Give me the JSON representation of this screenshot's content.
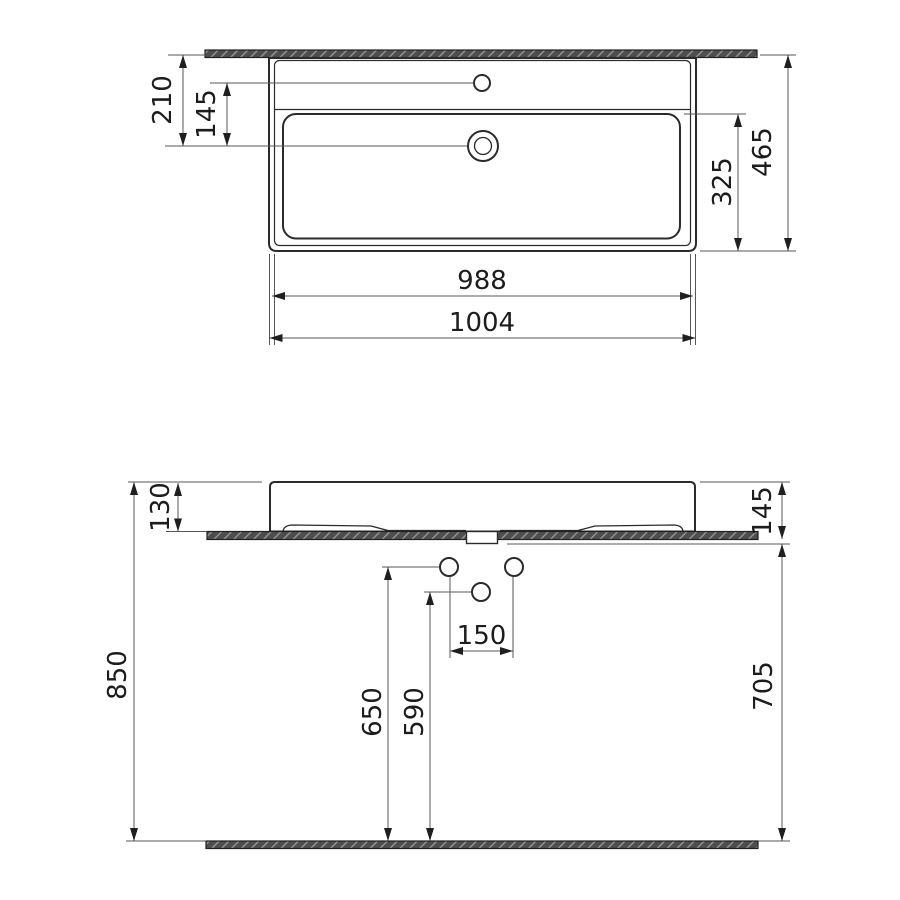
{
  "title": "Wall-hung washbasin dimensional drawing",
  "units": "mm",
  "colors": {
    "background": "#ffffff",
    "outline": "#2b2b2b",
    "dimension_lines": "#575757",
    "text": "#1c1c1c",
    "section_fill": "#4e4e4e",
    "section_hatch": "#9a9a9a"
  },
  "views": {
    "top": {
      "label": "plan-view",
      "dimensions": {
        "wall_to_drain": "210",
        "faucet_to_drain": "145",
        "basin_depth": "325",
        "overall_depth": "465",
        "inner_width": "988",
        "overall_width": "1004"
      }
    },
    "front": {
      "label": "front-view",
      "dimensions": {
        "body_height": "130",
        "rim_height_from_floor": "850",
        "hole_height_upper": "650",
        "hole_height_lower": "590",
        "hole_spacing": "150",
        "mounting_depth": "145",
        "underside_clearance": "705"
      }
    }
  }
}
